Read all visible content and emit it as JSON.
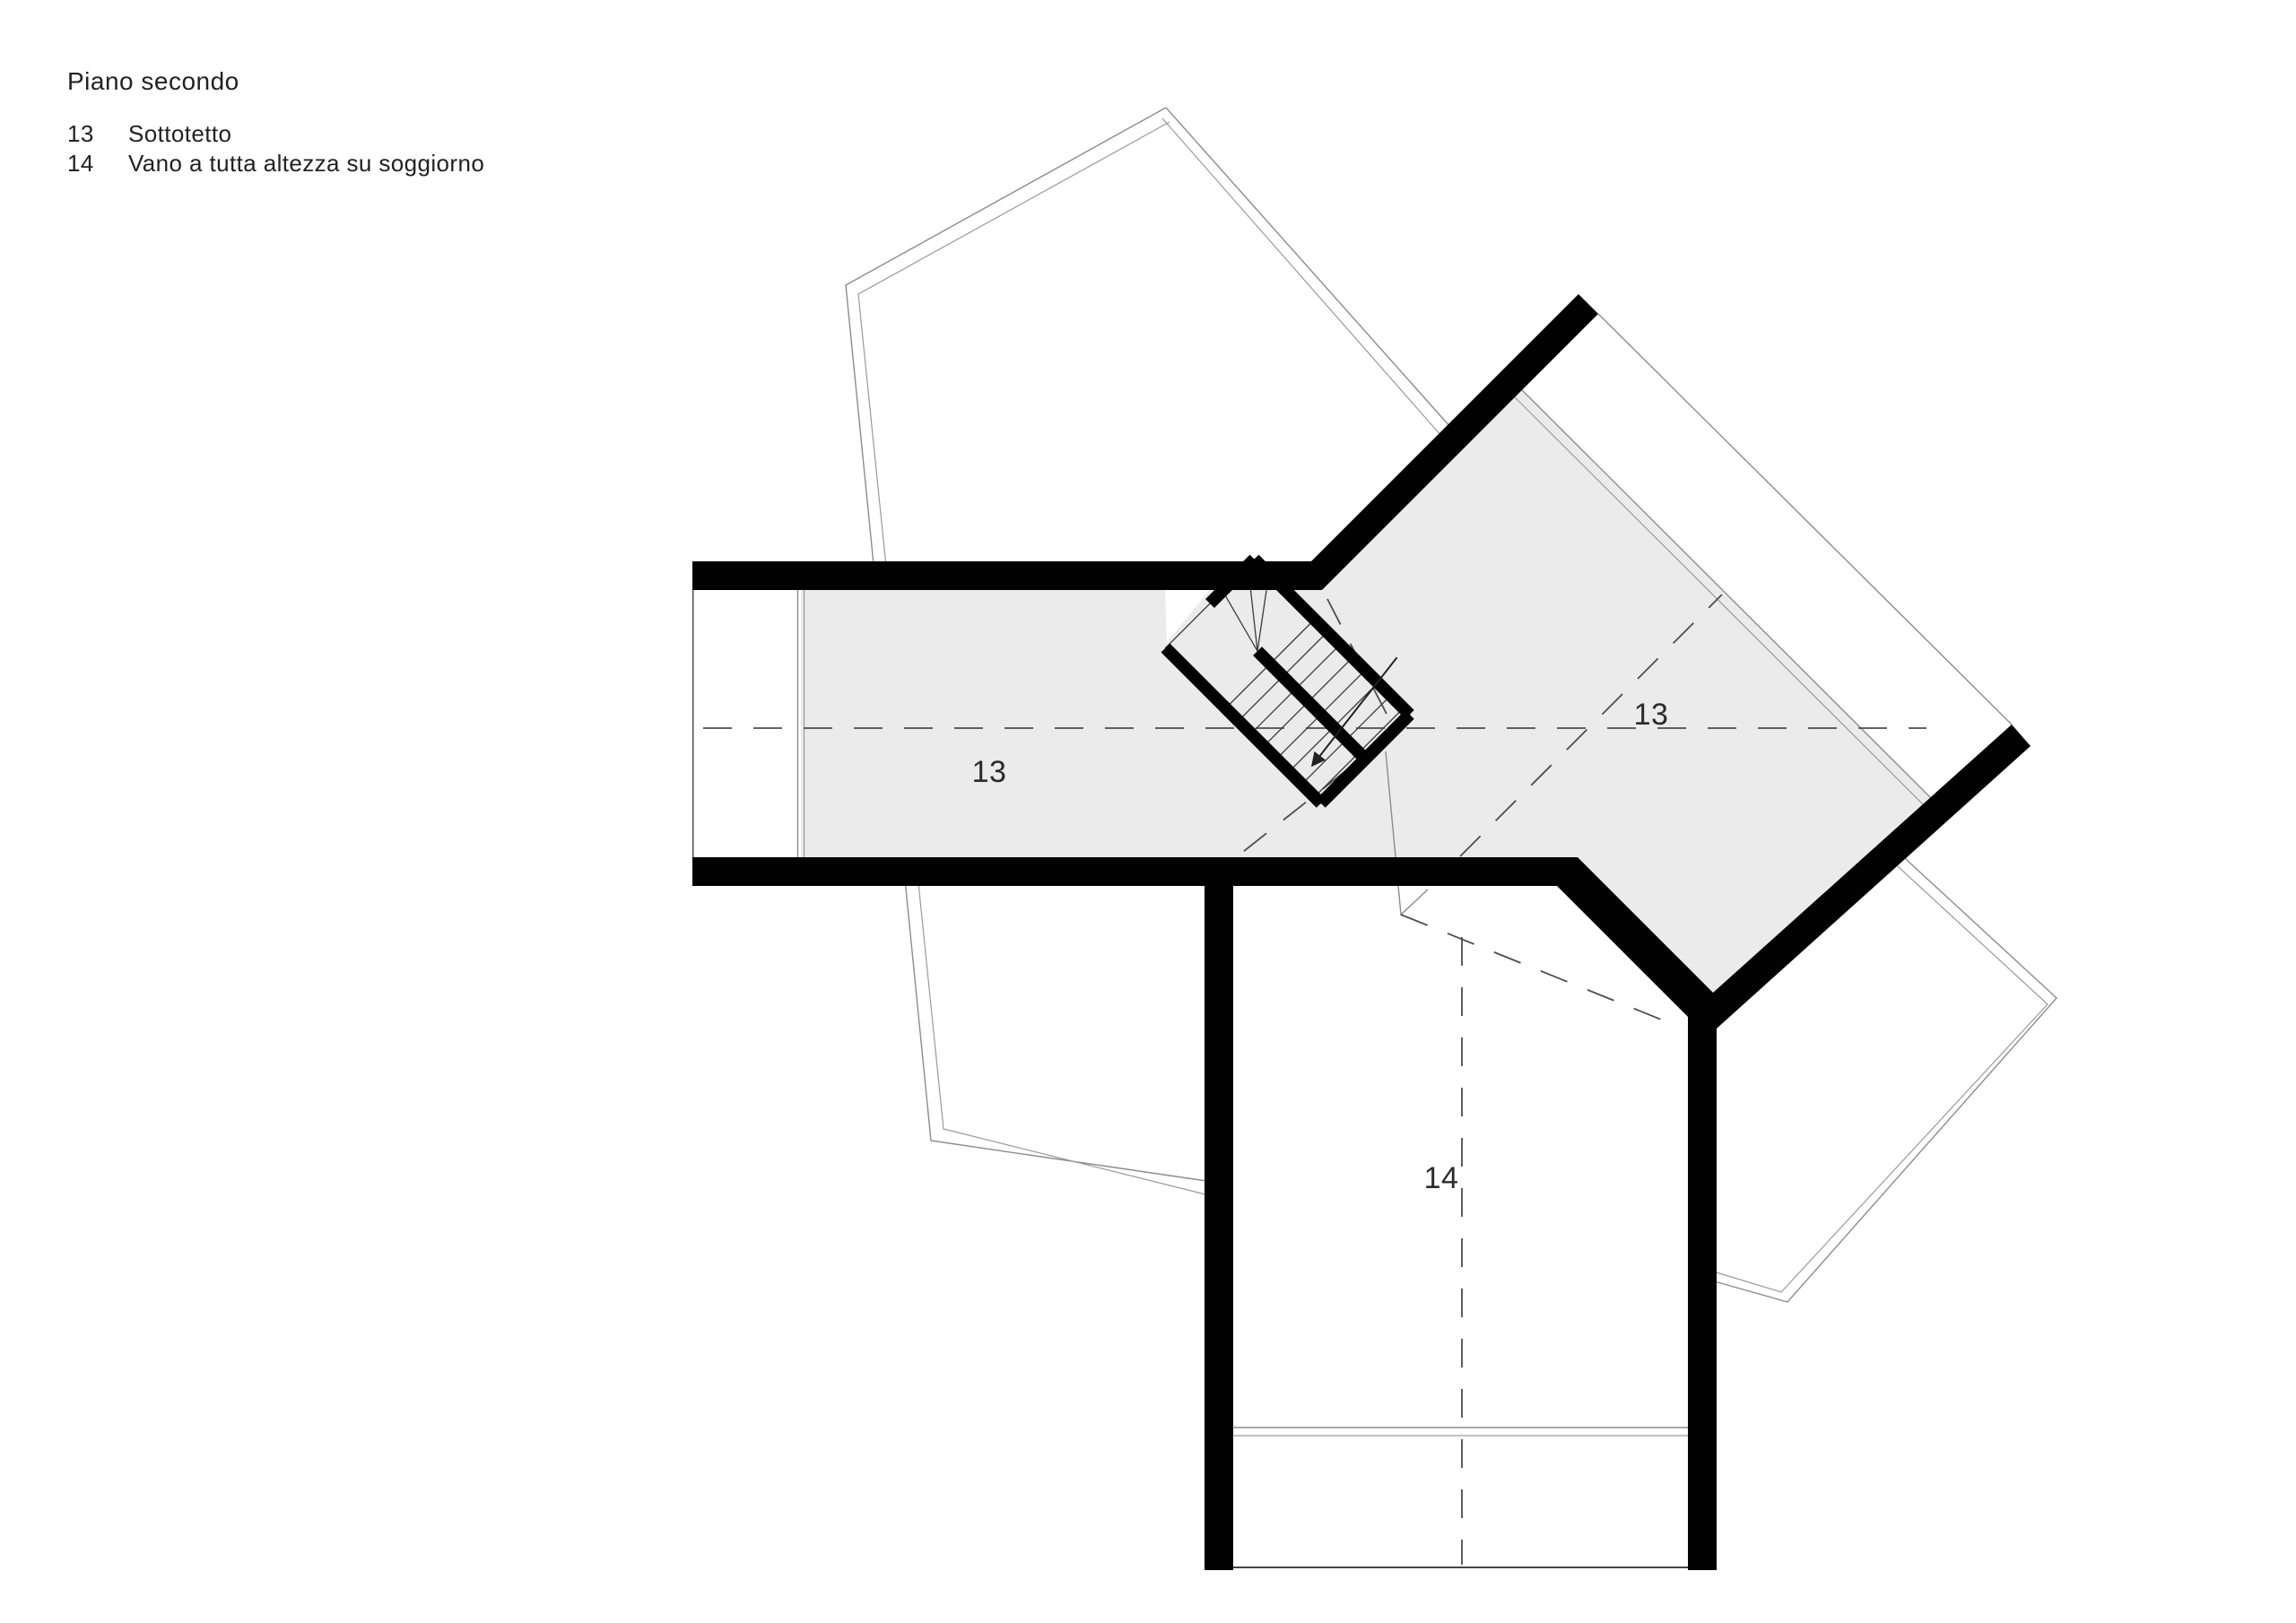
{
  "title": "Piano secondo",
  "legend": {
    "rows": [
      {
        "number": "13",
        "label": "Sottotetto"
      },
      {
        "number": "14",
        "label": "Vano a tutta altezza su soggiorno"
      }
    ]
  },
  "plan": {
    "labels": [
      {
        "id": "attic-left",
        "text": "13",
        "room": "Sottotetto"
      },
      {
        "id": "attic-right",
        "text": "13",
        "room": "Sottotetto"
      },
      {
        "id": "void-room",
        "text": "14",
        "room": "Vano a tutta altezza su soggiorno"
      }
    ],
    "colors": {
      "wall": "#020202",
      "floor_fill": "#ebebeb",
      "roof_outline": "#8c8c8c",
      "dashed_line": "#4d4d4d",
      "background": "#ffffff",
      "text": "#2b2b2b"
    }
  }
}
